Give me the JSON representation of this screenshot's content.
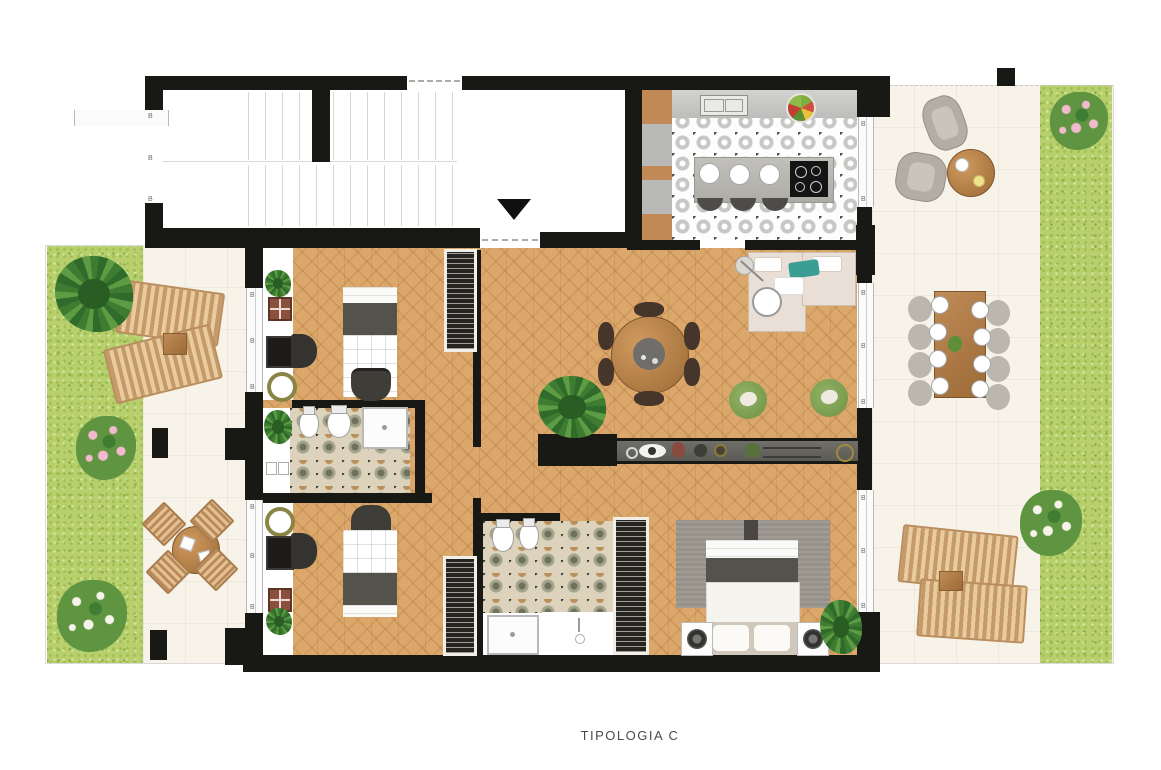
{
  "meta": {
    "caption": "TIPOLOGIA C",
    "window_mark": "B"
  },
  "palette": {
    "wall": "#181815",
    "parquet": "#dca76a",
    "terrace": "#f8f3e8",
    "grass": "#b7cf6d",
    "teal_pillow": "#3a9e94",
    "pouf_green": "#82a353",
    "wood": "#a8703e",
    "rug_gray": "#96928a",
    "kitchen_tile_gray": "#c7c7c5",
    "bath_tile_olive": "#6f705e",
    "bath_tile_tan": "#b9905c",
    "pink_flowers": "#f3b9cf",
    "white_flowers": "#f6f3ea"
  }
}
